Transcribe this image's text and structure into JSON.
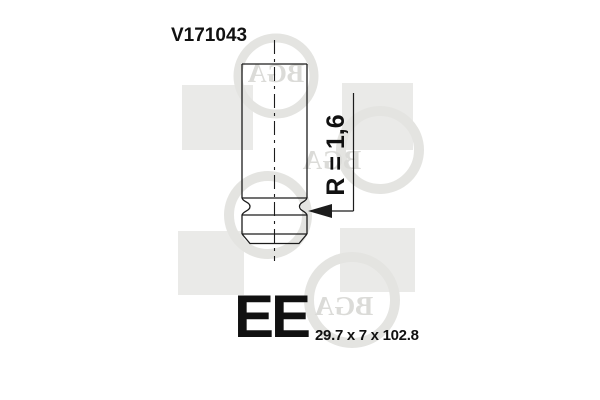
{
  "part": {
    "number": "V171043",
    "valve_code": "EE",
    "dimensions_label": "29.7 x 7 x 102.8",
    "radius_annotation": "R = 1,6"
  },
  "drawing": {
    "subject": "engine-valve-stem-tip-with-keeper-groove",
    "line_color": "#1c1c1c",
    "text_color": "#111111"
  },
  "watermark": {
    "brand": "BGA",
    "square_color": "#eaeae8",
    "ring_color": "#e4e4e1",
    "letter_color": "#dbdbd8"
  }
}
